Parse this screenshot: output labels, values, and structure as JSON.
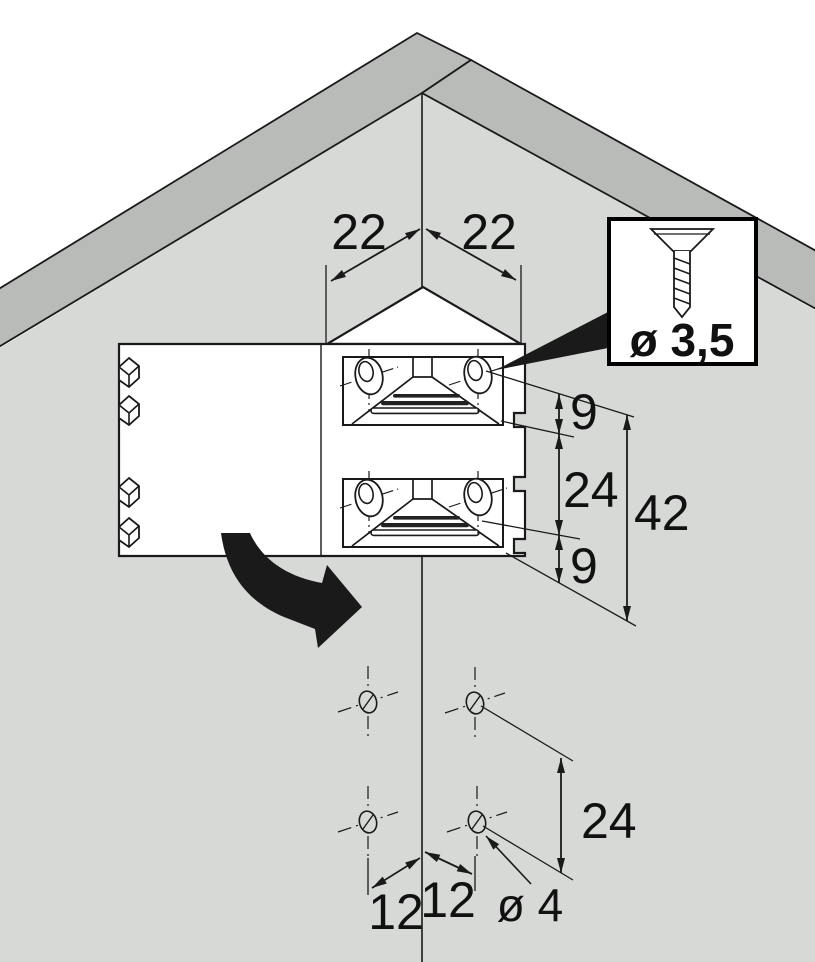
{
  "drawing": {
    "title": "corner-connector-installation-diagram",
    "dimensions": {
      "top_left": "22",
      "top_right": "22",
      "right_upper": "9",
      "right_middle": "24",
      "right_total": "42",
      "right_lower": "9",
      "bottom_vertical": "24",
      "bottom_left": "12",
      "bottom_right": "12",
      "hole_diameter": "ø 4",
      "screw_diameter": "ø 3,5"
    },
    "colors": {
      "background": "#ffffff",
      "panel_face": "#d7d9d7",
      "panel_edge_band": "#b9bbb9",
      "line": "#1a1a1a",
      "fill_white": "#ffffff"
    }
  }
}
